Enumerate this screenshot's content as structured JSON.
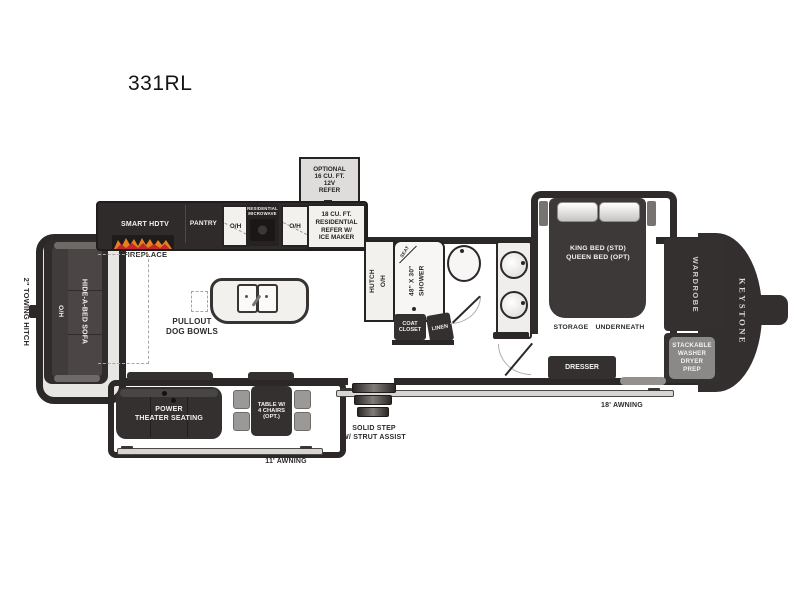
{
  "title": "331RL",
  "exterior": {
    "towing_hitch": "2\" TOWING HITCH",
    "optional_refer": "OPTIONAL\n16 CU. FT.\n12V\nREFER",
    "solid_step": "SOLID STEP\nW/ STRUT ASSIST",
    "awning_left": "11' AWNING",
    "awning_right": "18' AWNING",
    "brand": "KEYSTONE"
  },
  "living": {
    "smart_hdtv": "SMART HDTV",
    "pantry": "PANTRY",
    "oh_1": "O/H",
    "microwave": "RESIDENTIAL\nMICROWAVE",
    "oh_2": "O/H",
    "refer": "18 CU. FT.\nRESIDENTIAL\nREFER W/\nICE MAKER",
    "fireplace": "FIREPLACE",
    "sofa_oh": "O/H",
    "sofa": "HIDE-A-BED SOFA",
    "dog_bowls": "PULLOUT\nDOG BOWLS",
    "theater": "POWER\nTHEATER SEATING",
    "table": "TABLE W/\n4 CHAIRS\n(OPT.)"
  },
  "bath": {
    "hutch": "HUTCH\nO/H",
    "shower": "48\" X 30\"\nSHOWER",
    "seat": "SEAT",
    "coat_closet": "COAT\nCLOSET",
    "linen": "LINEN"
  },
  "bedroom": {
    "bed": "KING BED (STD)\nQUEEN BED (OPT)",
    "storage": "STORAGE  UNDERNEATH",
    "wardrobe": "WARDROBE",
    "dresser": "DRESSER",
    "stackable": "STACKABLE\nWASHER\nDRYER\nPREP"
  }
}
